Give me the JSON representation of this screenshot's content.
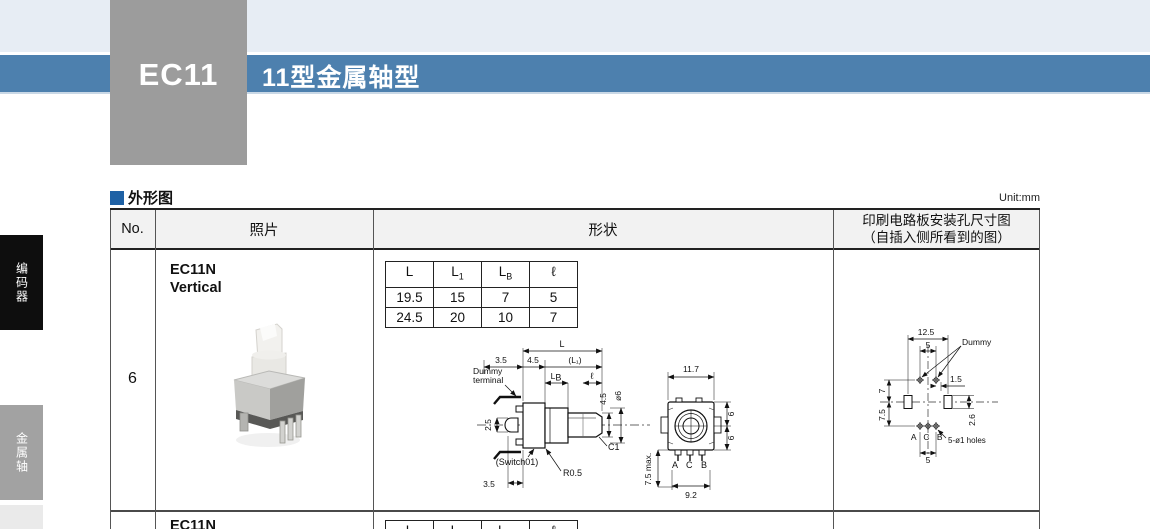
{
  "page": {
    "top_product": "EC11",
    "banner_title": "11型金属轴型",
    "section_heading": "外形图",
    "unit_label": "Unit:mm"
  },
  "sidebar": {
    "tab_encoder": "编码器",
    "tab_metal_shaft": "金属轴"
  },
  "table": {
    "headers": {
      "no": "No.",
      "photo": "照片",
      "shape": "形状",
      "pcb_line1": "印刷电路板安装孔尺寸图",
      "pcb_line2": "（自插入侧所看到的图）"
    },
    "row6": {
      "no": "6",
      "model": "EC11N",
      "orientation": "Vertical",
      "dim_table": {
        "col1": {
          "base": "L",
          "sub": ""
        },
        "col2": {
          "base": "L",
          "sub": "1"
        },
        "col3": {
          "base": "L",
          "sub": "B"
        },
        "col4": {
          "base": "ℓ",
          "sub": ""
        },
        "rows": [
          [
            "19.5",
            "15",
            "7",
            "5"
          ],
          [
            "24.5",
            "20",
            "10",
            "7"
          ]
        ]
      },
      "side_view": {
        "dim_L": "L",
        "dim_3_5_top": "3.5",
        "dim_4_5_top": "4.5",
        "dim_L1": "(L₁)",
        "dummy_label_1": "Dummy",
        "dummy_label_2": "terminal",
        "dim_LB_base": "L",
        "dim_LB_sub": "B",
        "dim_ell": "ℓ",
        "dim_2_5": "2.5",
        "dim_4_5_shaft": "4.5",
        "dim_dia6": "ø6",
        "chamfer": "C1",
        "switch_label": "(Switch01)",
        "radius": "R0.5",
        "dim_3_5_bottom": "3.5"
      },
      "front_view": {
        "dim_11_7": "11.7",
        "dim_6_top": "6",
        "dim_6_bottom": "6",
        "dim_7_5_max": "7.5 max.",
        "terminals": "A C B",
        "dim_9_2": "9.2"
      },
      "pcb_view": {
        "dim_12_5": "12.5",
        "dim_5_top": "5",
        "dummy_label": "Dummy",
        "dim_1_5": "1.5",
        "dim_7": "7",
        "dim_7_5": "7.5",
        "dim_2_6": "2.6",
        "terminals": "A C B",
        "holes_label": "5-ø1 holes",
        "dim_5_bottom": "5"
      }
    },
    "next_row": {
      "model": "EC11N"
    }
  }
}
